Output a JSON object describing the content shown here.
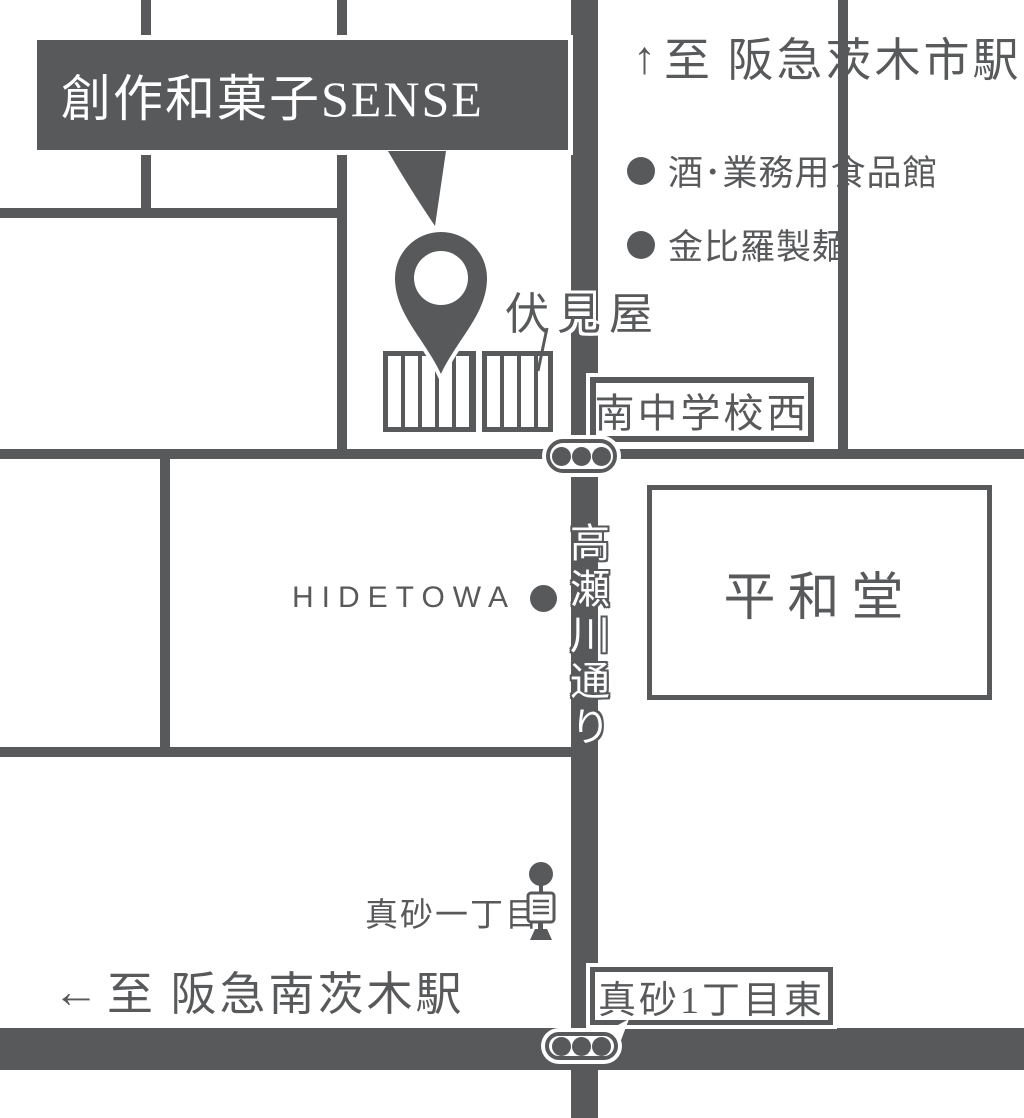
{
  "colors": {
    "ink": "#58595b",
    "background": "#ffffff"
  },
  "title": {
    "shop_name": "創作和菓子SENSE"
  },
  "directions": {
    "north": {
      "arrow": "↑",
      "label": "至 阪急茨木市駅"
    },
    "west": {
      "arrow": "←",
      "label": "至 阪急南茨木駅"
    }
  },
  "pois": [
    {
      "name": "酒･業務用食品館"
    },
    {
      "name": "金比羅製麺"
    },
    {
      "name": "HIDETOWA"
    }
  ],
  "landmarks": {
    "fushimiya": "伏見屋",
    "heiwado": "平和堂",
    "bus_stop": "真砂一丁目"
  },
  "intersections": {
    "south_junior_high_west": "南中学校西",
    "masago_1chome_east": "真砂1丁目東"
  },
  "streets": {
    "takasegawa": "高瀬川通り"
  }
}
